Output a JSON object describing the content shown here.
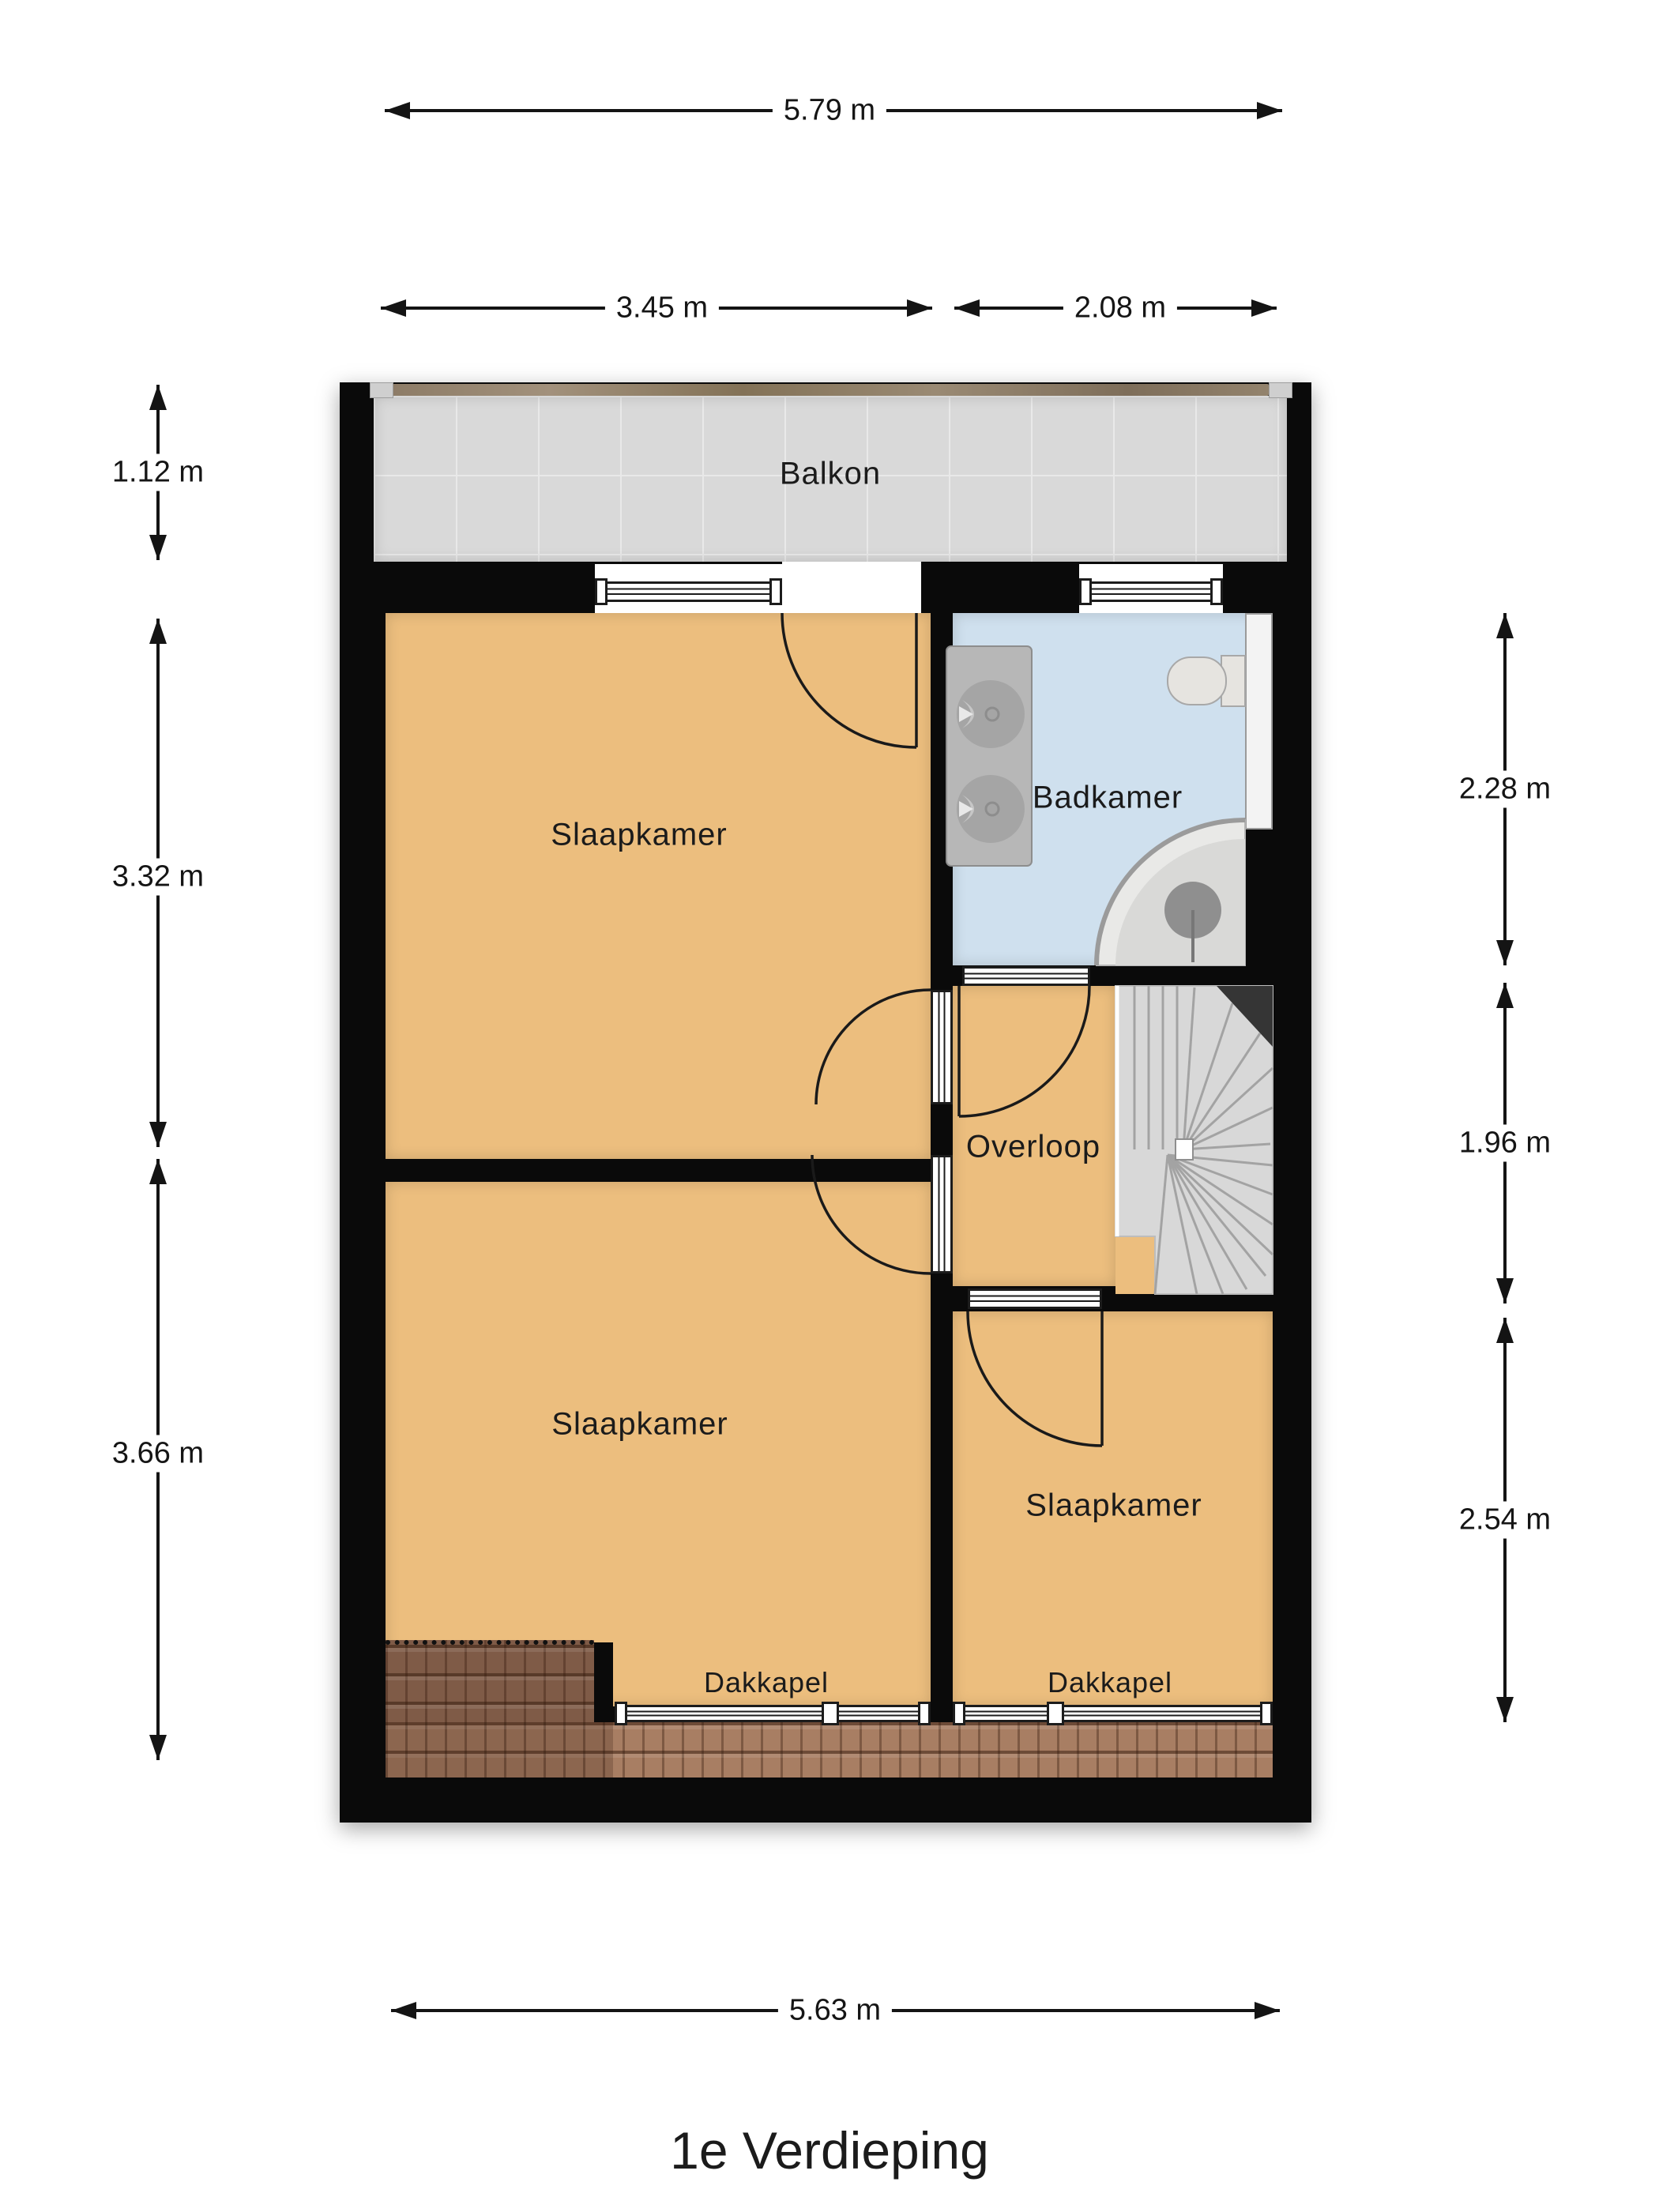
{
  "title": "1e Verdieping",
  "plan": {
    "rooms": [
      {
        "id": "balkon",
        "label": "Balkon"
      },
      {
        "id": "slaapkamer-1",
        "label": "Slaapkamer"
      },
      {
        "id": "badkamer",
        "label": "Badkamer"
      },
      {
        "id": "overloop",
        "label": "Overloop"
      },
      {
        "id": "slaapkamer-2",
        "label": "Slaapkamer"
      },
      {
        "id": "slaapkamer-3",
        "label": "Slaapkamer"
      },
      {
        "id": "dakkapel-links",
        "label": "Dakkapel"
      },
      {
        "id": "dakkapel-rechts",
        "label": "Dakkapel"
      }
    ],
    "dimensions": {
      "top_total": "5.79 m",
      "top_left": "3.45 m",
      "top_right": "2.08 m",
      "left_balkon": "1.12 m",
      "left_mid": "3.32 m",
      "left_bottom": "3.66 m",
      "right_top": "2.28 m",
      "right_mid": "1.96 m",
      "right_bottom": "2.54 m",
      "bottom_total": "5.63 m"
    },
    "colors": {
      "wall_black": "#0a0a0a",
      "floor_orange": "#ecbe7e",
      "bathroom_blue": "#cfe0ee",
      "balcony_grey": "#d9d9d9",
      "roof_brown": "#a87e63",
      "roof_dark_brown": "#7f5b47",
      "stairs_grey": "#d8d8d8",
      "railing_wood": "#8d7c67"
    }
  }
}
